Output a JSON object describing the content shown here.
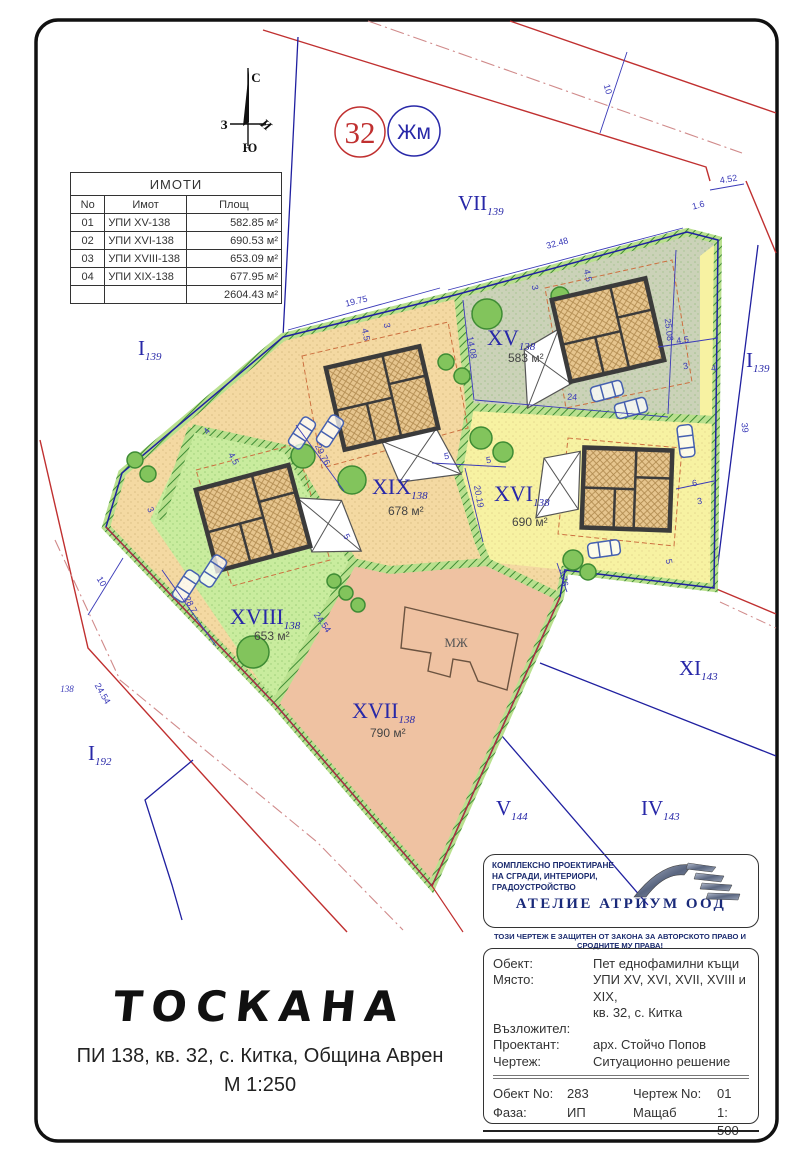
{
  "compass": {
    "north": "С",
    "west": "З",
    "south": "Ю",
    "east": "И"
  },
  "badges": {
    "block_number": "32",
    "zone": "Жм"
  },
  "table": {
    "title": "ИМОТИ",
    "headers": [
      "No",
      "Имот",
      "Площ"
    ],
    "rows": [
      [
        "01",
        "УПИ XV-138",
        "582.85 м²"
      ],
      [
        "02",
        "УПИ XVI-138",
        "690.53 м²"
      ],
      [
        "03",
        "УПИ XVIII-138",
        "653.09 м²"
      ],
      [
        "04",
        "УПИ XIX-138",
        "677.95 м²"
      ]
    ],
    "total": "2604.43 м²"
  },
  "building_label": "МЖ",
  "plan": {
    "parcel_labels": [
      {
        "roman": "XV",
        "sub": "138",
        "area": "583 м²",
        "x": 487,
        "y": 345,
        "ax": 508,
        "ay": 362
      },
      {
        "roman": "XVI",
        "sub": "138",
        "area": "690 м²",
        "x": 494,
        "y": 501,
        "ax": 512,
        "ay": 526
      },
      {
        "roman": "XIX",
        "sub": "138",
        "area": "678 м²",
        "x": 372,
        "y": 494,
        "ax": 388,
        "ay": 515
      },
      {
        "roman": "XVIII",
        "sub": "138",
        "area": "653 м²",
        "x": 230,
        "y": 624,
        "ax": 254,
        "ay": 640
      },
      {
        "roman": "XVII",
        "sub": "138",
        "area": "790 м²",
        "x": 352,
        "y": 718,
        "ax": 370,
        "ay": 737
      }
    ],
    "neighbor_labels": [
      {
        "roman": "VII",
        "sub": "139",
        "x": 458,
        "y": 210
      },
      {
        "roman": "I",
        "sub": "139",
        "x": 138,
        "y": 355
      },
      {
        "roman": "I",
        "sub": "139",
        "x": 746,
        "y": 367
      },
      {
        "roman": "XI",
        "sub": "143",
        "x": 679,
        "y": 675
      },
      {
        "roman": "IV",
        "sub": "143",
        "x": 641,
        "y": 815
      },
      {
        "roman": "V",
        "sub": "144",
        "x": 496,
        "y": 815
      },
      {
        "roman": "I",
        "sub": "192",
        "x": 88,
        "y": 760
      }
    ],
    "dimensions": [
      {
        "t": "32.48",
        "x": 558,
        "y": 246,
        "r": -15
      },
      {
        "t": "19.75",
        "x": 357,
        "y": 304,
        "r": -14
      },
      {
        "t": "25.08",
        "x": 666,
        "y": 330,
        "r": 83
      },
      {
        "t": "4.52",
        "x": 729,
        "y": 182,
        "r": -10
      },
      {
        "t": "1.6",
        "x": 699,
        "y": 208,
        "r": -15
      },
      {
        "t": "10",
        "x": 605,
        "y": 90,
        "r": 74
      },
      {
        "t": "10",
        "x": 99,
        "y": 583,
        "r": 58
      },
      {
        "t": "39",
        "x": 742,
        "y": 428,
        "r": 83
      },
      {
        "t": "14.08",
        "x": 469,
        "y": 348,
        "r": 80
      },
      {
        "t": "24",
        "x": 572,
        "y": 400,
        "r": 4
      },
      {
        "t": "4.5",
        "x": 683,
        "y": 343,
        "r": -8
      },
      {
        "t": "3",
        "x": 686,
        "y": 369,
        "r": -8
      },
      {
        "t": "4",
        "x": 714,
        "y": 371,
        "r": -8
      },
      {
        "t": "29.76",
        "x": 320,
        "y": 456,
        "r": 62
      },
      {
        "t": "20.19",
        "x": 476,
        "y": 497,
        "r": 80
      },
      {
        "t": "28.7",
        "x": 188,
        "y": 606,
        "r": 62
      },
      {
        "t": "24.54",
        "x": 320,
        "y": 624,
        "r": 55
      },
      {
        "t": "24.54",
        "x": 100,
        "y": 695,
        "r": 60
      },
      {
        "t": "138",
        "x": 67,
        "y": 692,
        "r": 0
      },
      {
        "t": "3.76",
        "x": 561,
        "y": 578,
        "r": 80
      },
      {
        "t": "6",
        "x": 695,
        "y": 486,
        "r": -8
      },
      {
        "t": "3",
        "x": 700,
        "y": 504,
        "r": -8
      },
      {
        "t": "5",
        "x": 666,
        "y": 562,
        "r": 80
      },
      {
        "t": "5",
        "x": 447,
        "y": 459,
        "r": -8
      },
      {
        "t": "5",
        "x": 489,
        "y": 463,
        "r": -8
      },
      {
        "t": "4.5",
        "x": 363,
        "y": 335,
        "r": 80
      },
      {
        "t": "3",
        "x": 384,
        "y": 326,
        "r": 80
      },
      {
        "t": "4.5",
        "x": 585,
        "y": 276,
        "r": 80
      },
      {
        "t": "3",
        "x": 532,
        "y": 288,
        "r": 80
      },
      {
        "t": "4.5",
        "x": 231,
        "y": 460,
        "r": 62
      },
      {
        "t": "3",
        "x": 148,
        "y": 511,
        "r": 62
      },
      {
        "t": "5",
        "x": 344,
        "y": 538,
        "r": 62
      },
      {
        "t": "4",
        "x": 209,
        "y": 433,
        "r": -50
      }
    ]
  },
  "footer_left": {
    "title": "ТОСКАНА",
    "line1": "ПИ 138, кв. 32, с. Китка, Община Аврен",
    "line2": "М 1:250"
  },
  "company": {
    "lines": [
      "КОМПЛЕКСНО ПРОЕКТИРАНЕ",
      "НА СГРАДИ, ИНТЕРИОРИ,",
      "ГРАДОУСТРОЙСТВО"
    ],
    "name": "АТЕЛИЕ АТРИУМ ООД",
    "copyright": "ТОЗИ ЧЕРТЕЖ Е ЗАЩИТЕН ОТ ЗАКОНА ЗА АВТОРСКОТО ПРАВО И СРОДНИТЕ МУ ПРАВА!"
  },
  "title_block": {
    "rows": [
      {
        "label": "Обект:",
        "value": "Пет еднофамилни къщи"
      },
      {
        "label": "Място:",
        "value": "УПИ XV, XVI, XVII, XVIII и XIX,",
        "value2": "кв. 32, с. Китка"
      },
      {
        "label": "Възложител:",
        "value": ""
      },
      {
        "label": "Проектант:",
        "value": "арх. Стойчо Попов"
      },
      {
        "label": "Чертеж:",
        "value": "Ситуационно решение"
      }
    ],
    "footer": {
      "object_label": "Обект No:",
      "object_value": "283",
      "drawing_label": "Чертеж No:",
      "drawing_value": "01",
      "phase_label": "Фаза:",
      "phase_value": "ИП",
      "scale_label": "Мащаб",
      "scale_value": "1: 500"
    }
  },
  "colors": {
    "parcel_xv": "#cbd2b8",
    "parcel_xvi": "#f7f2a2",
    "parcel_xvii": "#efc2a2",
    "parcel_xviii": "#c9ec9e",
    "parcel_xix": "#f4d9a2",
    "boundary_blue": "#2020a0",
    "road_red": "#c03030",
    "dimension_blue": "#3a3ab8",
    "hatch_green": "#3e8c34",
    "label_navy": "#2828a8"
  }
}
